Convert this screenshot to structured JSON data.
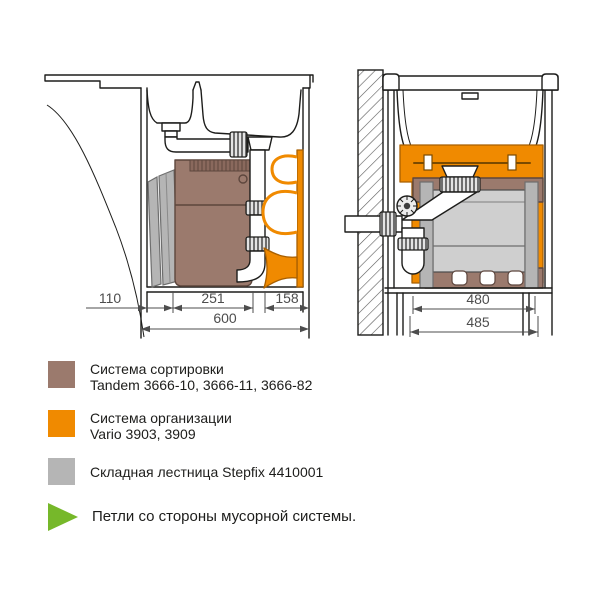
{
  "colors": {
    "sorting_brown": "#9b7a6d",
    "organizer_orange": "#f08a00",
    "ladder_gray": "#b5b5b5",
    "hinge_green": "#76b82a",
    "line_art": "#1d1d1b",
    "dimension_gray": "#4d4d4d"
  },
  "diagrams": {
    "left": {
      "dims": {
        "zone_ladder": "110",
        "zone_bin": "251",
        "zone_vario": "158",
        "total": "600"
      }
    },
    "right": {
      "dims": {
        "inner": "480",
        "outer": "485"
      }
    }
  },
  "legend": {
    "items": [
      {
        "id": "sorting-system",
        "color": "#9b7a6d",
        "line1": "Система сортировки",
        "line2": "Tandem 3666-10, 3666-11, 3666-82"
      },
      {
        "id": "organizer-system",
        "color": "#f08a00",
        "line1": "Система организации",
        "line2": "Vario 3903, 3909"
      },
      {
        "id": "folding-ladder",
        "color": "#b5b5b5",
        "line1": "Складная лестница Stepfix 4410001"
      },
      {
        "id": "hinge-note",
        "color": "#76b82a",
        "line1": "Петли со стороны мусорной системы."
      }
    ]
  }
}
